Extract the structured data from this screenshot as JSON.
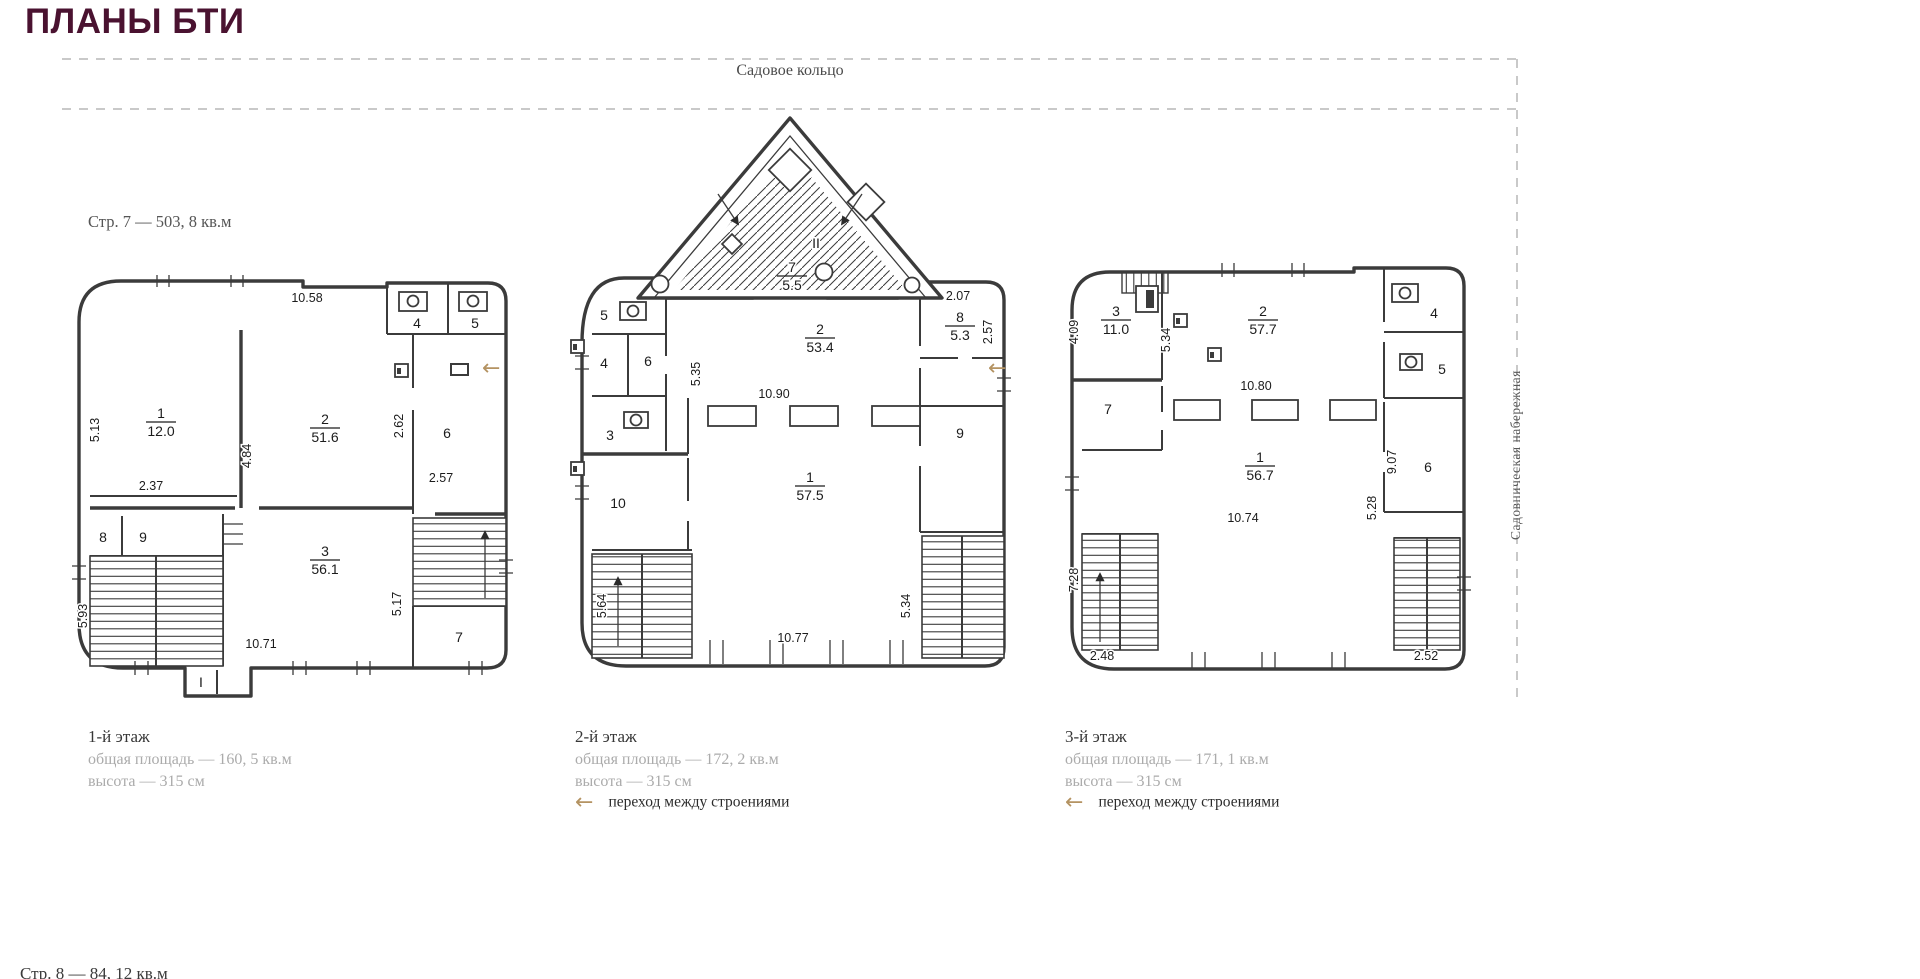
{
  "page": {
    "title": "ПЛАНЫ БТИ",
    "street_top": "Садовое кольцо",
    "street_right": "Садовническая набережная",
    "bottom_clipped": "Стр. 8 — 84, 12 кв.м",
    "transition_label": "переход между строениями",
    "arrow_glyph": "←",
    "colors": {
      "accent": "#4a1230",
      "tan": "#b49362",
      "caption_gray": "#ababab",
      "line": "#3b3b3b"
    }
  },
  "plans": [
    {
      "id": "floor-1",
      "header": "Стр. 7 — 503, 8 кв.м",
      "caption": {
        "title": "1-й этаж",
        "area": "общая площадь — 160, 5 кв.м",
        "height": "высота — 315 см"
      },
      "fractions": [
        {
          "num": "1",
          "area": "12.0",
          "x": 96,
          "y": 150
        },
        {
          "num": "2",
          "area": "51.6",
          "x": 260,
          "y": 156
        },
        {
          "num": "3",
          "area": "56.1",
          "x": 260,
          "y": 288
        }
      ],
      "numbers": [
        {
          "t": "4",
          "x": 352,
          "y": 60
        },
        {
          "t": "5",
          "x": 410,
          "y": 60
        },
        {
          "t": "6",
          "x": 382,
          "y": 170
        },
        {
          "t": "8",
          "x": 38,
          "y": 274
        },
        {
          "t": "9",
          "x": 78,
          "y": 274
        },
        {
          "t": "7",
          "x": 394,
          "y": 374
        },
        {
          "t": "I",
          "x": 136,
          "y": 419
        }
      ],
      "dims": [
        {
          "t": "5.13",
          "x": 34,
          "y": 162,
          "v": true
        },
        {
          "t": "10.58",
          "x": 242,
          "y": 34
        },
        {
          "t": "4.84",
          "x": 186,
          "y": 188,
          "v": true
        },
        {
          "t": "2.37",
          "x": 86,
          "y": 222
        },
        {
          "t": "2.62",
          "x": 338,
          "y": 158,
          "v": true
        },
        {
          "t": "2.57",
          "x": 376,
          "y": 214
        },
        {
          "t": "5.93",
          "x": 22,
          "y": 348,
          "v": true
        },
        {
          "t": "10.71",
          "x": 196,
          "y": 380
        },
        {
          "t": "5.17",
          "x": 336,
          "y": 336,
          "v": true
        }
      ]
    },
    {
      "id": "floor-2",
      "header": "",
      "caption": {
        "title": "2-й этаж",
        "area": "общая площадь — 172, 2 кв.м",
        "height": "высота — 315 см"
      },
      "fractions": [
        {
          "num": "7",
          "area": "5.5",
          "x": 224,
          "y": 166
        },
        {
          "num": "2",
          "area": "53.4",
          "x": 252,
          "y": 228
        },
        {
          "num": "8",
          "area": "5.3",
          "x": 392,
          "y": 216
        },
        {
          "num": "1",
          "area": "57.5",
          "x": 242,
          "y": 376
        }
      ],
      "numbers": [
        {
          "t": "II",
          "x": 248,
          "y": 142
        },
        {
          "t": "5",
          "x": 36,
          "y": 214
        },
        {
          "t": "4",
          "x": 36,
          "y": 262
        },
        {
          "t": "6",
          "x": 80,
          "y": 260
        },
        {
          "t": "3",
          "x": 42,
          "y": 334
        },
        {
          "t": "10",
          "x": 50,
          "y": 402
        },
        {
          "t": "9",
          "x": 392,
          "y": 332
        }
      ],
      "dims": [
        {
          "t": "5.35",
          "x": 132,
          "y": 268,
          "v": true
        },
        {
          "t": "10.90",
          "x": 206,
          "y": 292
        },
        {
          "t": "2.07",
          "x": 390,
          "y": 194
        },
        {
          "t": "2.57",
          "x": 424,
          "y": 226,
          "v": true
        },
        {
          "t": "5.64",
          "x": 38,
          "y": 500,
          "v": true
        },
        {
          "t": "10.77",
          "x": 225,
          "y": 536
        },
        {
          "t": "5.34",
          "x": 342,
          "y": 500,
          "v": true
        }
      ]
    },
    {
      "id": "floor-3",
      "header": "",
      "caption": {
        "title": "3-й этаж",
        "area": "общая площадь — 171, 1 кв.м",
        "height": "высота — 315 см"
      },
      "fractions": [
        {
          "num": "3",
          "area": "11.0",
          "x": 58,
          "y": 54
        },
        {
          "num": "2",
          "area": "57.7",
          "x": 205,
          "y": 54
        },
        {
          "num": "1",
          "area": "56.7",
          "x": 202,
          "y": 200
        }
      ],
      "numbers": [
        {
          "t": "7",
          "x": 50,
          "y": 152
        },
        {
          "t": "4",
          "x": 376,
          "y": 56
        },
        {
          "t": "5",
          "x": 384,
          "y": 112
        },
        {
          "t": "6",
          "x": 370,
          "y": 210
        }
      ],
      "dims": [
        {
          "t": "4.09",
          "x": 20,
          "y": 70,
          "v": true
        },
        {
          "t": "5.34",
          "x": 112,
          "y": 78,
          "v": true
        },
        {
          "t": "10.80",
          "x": 198,
          "y": 128
        },
        {
          "t": "9.07",
          "x": 338,
          "y": 200,
          "v": true
        },
        {
          "t": "10.74",
          "x": 185,
          "y": 260
        },
        {
          "t": "5.28",
          "x": 318,
          "y": 246,
          "v": true
        },
        {
          "t": "2.48",
          "x": 44,
          "y": 398
        },
        {
          "t": "2.52",
          "x": 368,
          "y": 398
        },
        {
          "t": "7.28",
          "x": 20,
          "y": 318,
          "v": true
        }
      ]
    }
  ]
}
